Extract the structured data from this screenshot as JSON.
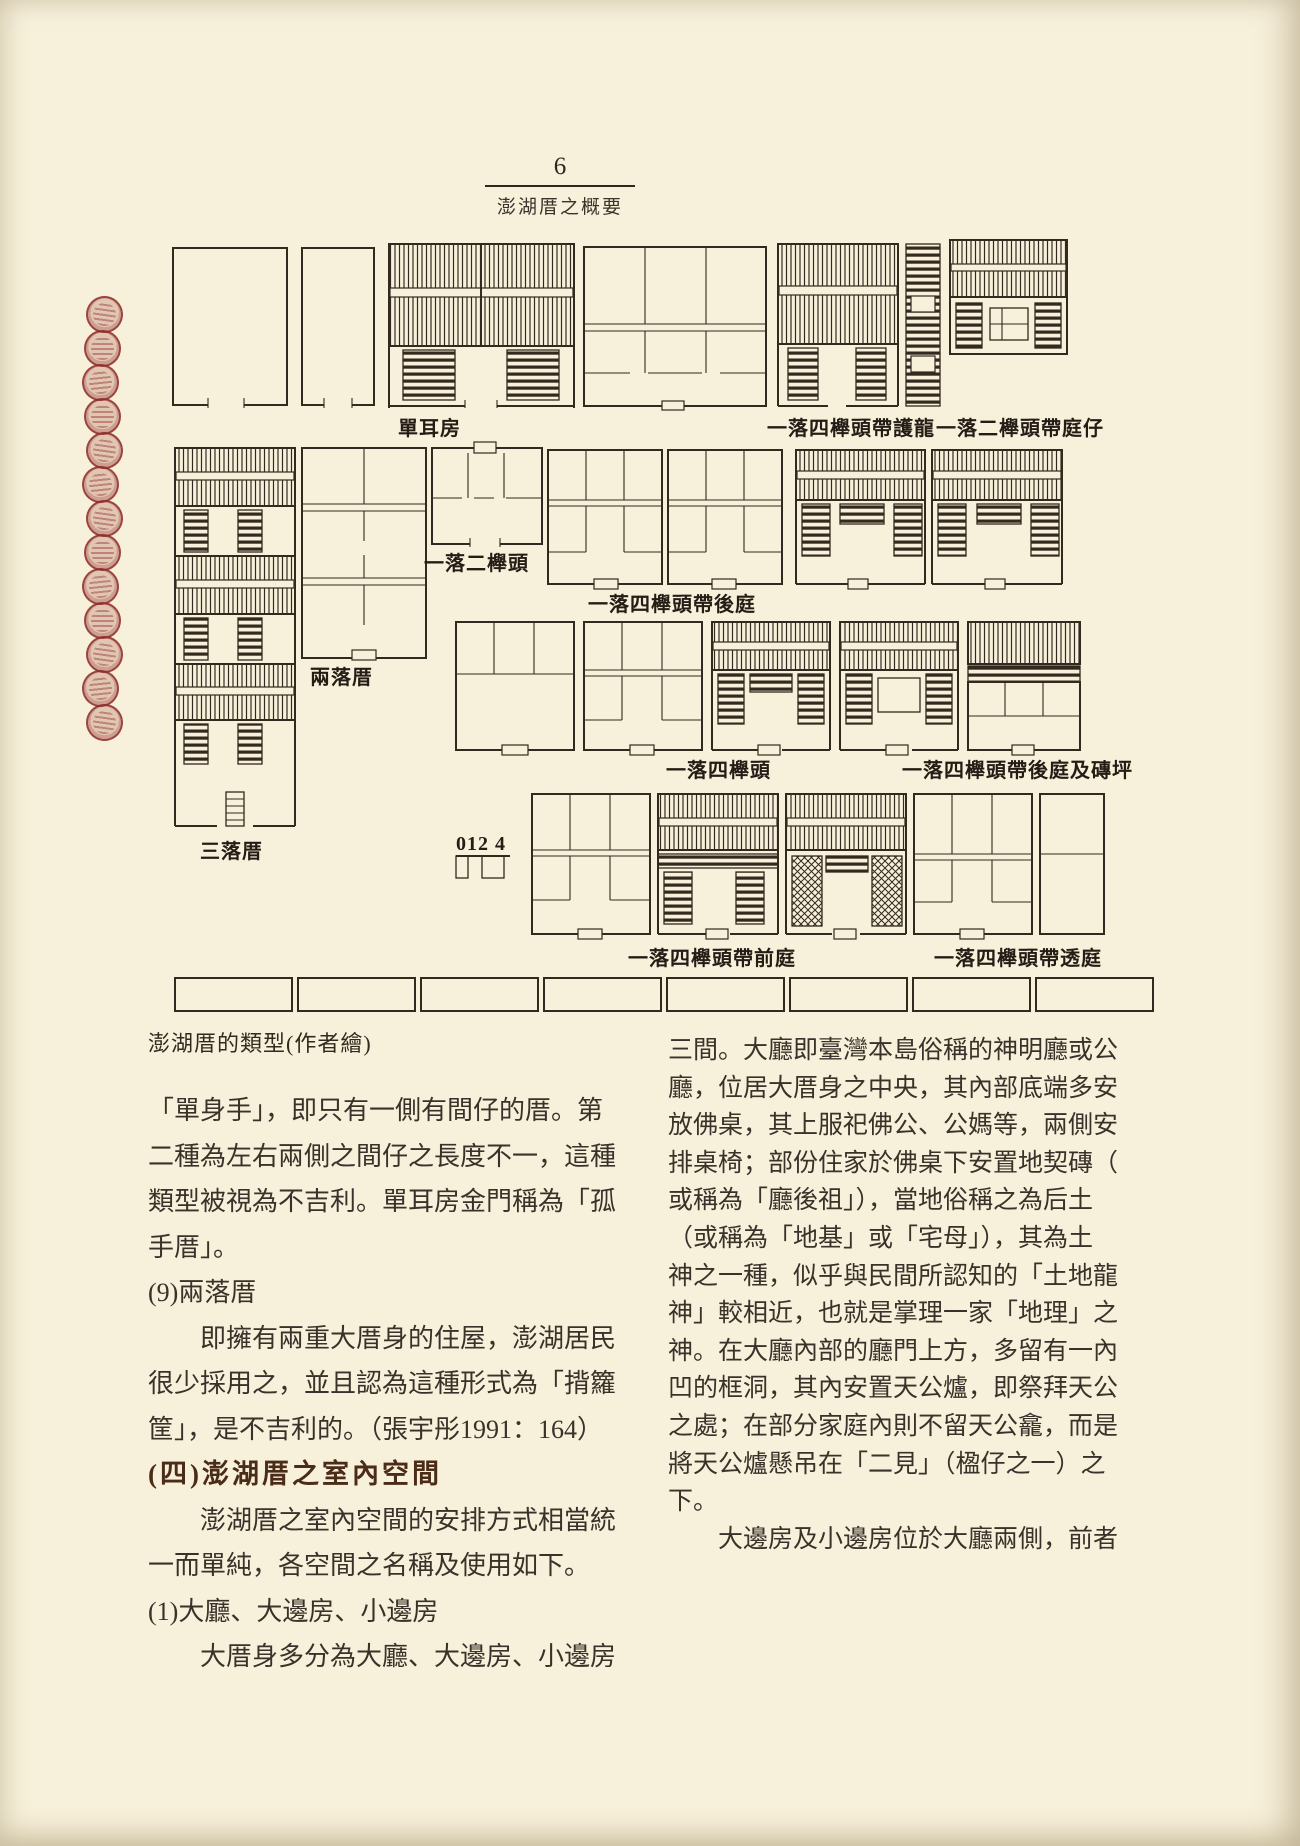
{
  "page": {
    "number": "6",
    "running_title": "澎湖厝之概要"
  },
  "figure": {
    "caption": "澎湖厝的類型(作者繪)",
    "scale_label": "012 4",
    "labels": [
      "單耳房",
      "一落四櫸頭帶護龍",
      "一落二櫸頭帶庭仔",
      "一落二櫸頭",
      "一落四櫸頭帶後庭",
      "兩落厝",
      "三落厝",
      "一落四櫸頭",
      "一落四櫸頭帶後庭及磚坪",
      "一落四櫸頭帶前庭",
      "一落四櫸頭帶透庭"
    ]
  },
  "left_column": {
    "lines": [
      "「單身手」，即只有一側有間仔的厝。第",
      "二種為左右兩側之間仔之長度不一，這種",
      "類型被視為不吉利。單耳房金門稱為「孤",
      "手厝」。",
      "(9)兩落厝",
      "　　即擁有兩重大厝身的住屋，澎湖居民",
      "很少採用之，並且認為這種形式為「揹籮",
      "筐」，是不吉利的。（張宇彤1991：164）",
      "(四)澎湖厝之室內空間",
      "　　澎湖厝之室內空間的安排方式相當統",
      "一而單純，各空間之名稱及使用如下。",
      "(1)大廳、大邊房、小邊房",
      "　　大厝身多分為大廳、大邊房、小邊房"
    ]
  },
  "right_column": {
    "lines": [
      "三間。大廳即臺灣本島俗稱的神明廳或公",
      "廳，位居大厝身之中央，其內部底端多安",
      "放佛桌，其上服祀佛公、公媽等，兩側安",
      "排桌椅；部份住家於佛桌下安置地契磚（",
      "或稱為「廳後祖」），當地俗稱之為后土",
      "（或稱為「地基」或「宅母」），其為土",
      "神之一種，似乎與民間所認知的「土地龍",
      "神」較相近，也就是掌理一家「地理」之",
      "神。在大廳內部的廳門上方，多留有一內",
      "凹的框洞，其內安置天公爐，即祭拜天公",
      "之處；在部分家庭內則不留天公龕，而是",
      "將天公爐懸吊在「二見」（楹仔之一）之",
      "下。",
      "　　大邊房及小邊房位於大廳兩側，前者"
    ]
  }
}
